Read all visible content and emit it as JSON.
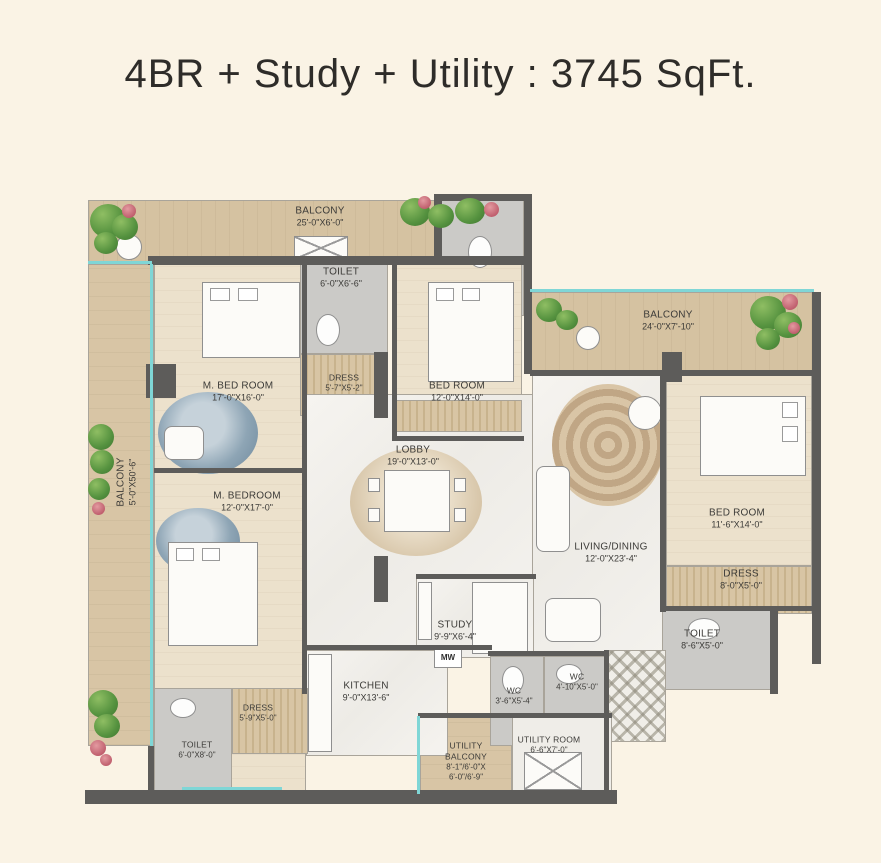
{
  "title": "4BR + Study + Utility : 3745 SqFt.",
  "labels": {
    "mw": "MW"
  },
  "rooms": {
    "balcony_top": {
      "name": "BALCONY",
      "dims": "25'-0\"X6'-0\""
    },
    "balcony_left": {
      "name": "BALCONY",
      "dims": "5'-0\"X50'-6\""
    },
    "balcony_right": {
      "name": "BALCONY",
      "dims": "24'-0\"X7'-10\""
    },
    "m_bed_room": {
      "name": "M. BED ROOM",
      "dims": "17'-0\"X16'-0\""
    },
    "toilet_top": {
      "name": "TOILET",
      "dims": "6'-0\"X6'-6\""
    },
    "dress_top": {
      "name": "DRESS",
      "dims": "5'-7\"X5'-2\""
    },
    "bed_room_top": {
      "name": "BED ROOM",
      "dims": "12'-0\"X14'-0\""
    },
    "lobby": {
      "name": "LOBBY",
      "dims": "19'-0\"X13'-0\""
    },
    "m_bedroom": {
      "name": "M. BEDROOM",
      "dims": "12'-0\"X17'-0\""
    },
    "living_dining": {
      "name": "LIVING/DINING",
      "dims": "12'-0\"X23'-4\""
    },
    "bed_room_right": {
      "name": "BED ROOM",
      "dims": "11'-6\"X14'-0\""
    },
    "dress_right": {
      "name": "DRESS",
      "dims": "8'-0\"X5'-0\""
    },
    "toilet_right": {
      "name": "TOILET",
      "dims": "8'-6\"X5'-0\""
    },
    "study": {
      "name": "STUDY",
      "dims": "9'-9\"X6'-4\""
    },
    "kitchen": {
      "name": "KITCHEN",
      "dims": "9'-0\"X13'-6\""
    },
    "wc_left": {
      "name": "WC",
      "dims": "3'-6\"X5'-4\""
    },
    "wc_right": {
      "name": "WC",
      "dims": "4'-10\"X5'-0\""
    },
    "dress_bottom": {
      "name": "DRESS",
      "dims": "5'-9\"X5'-0\""
    },
    "toilet_bottom": {
      "name": "TOILET",
      "dims": "6'-0\"X8'-0\""
    },
    "utility_balcony": {
      "name": "UTILITY BALCONY",
      "dims": "8'-1\"/6'-0\"X",
      "dims2": "6'-0\"/6'-9\""
    },
    "utility_room": {
      "name": "UTILITY ROOM",
      "dims": "6'-6\"X7'-0\""
    }
  },
  "colors": {
    "background": "#faf3e5",
    "balcony_floor": "#d5c2a1",
    "wall": "#5d5c5a",
    "railing_teal": "#7fd6d6",
    "greenery": "#55923f"
  }
}
